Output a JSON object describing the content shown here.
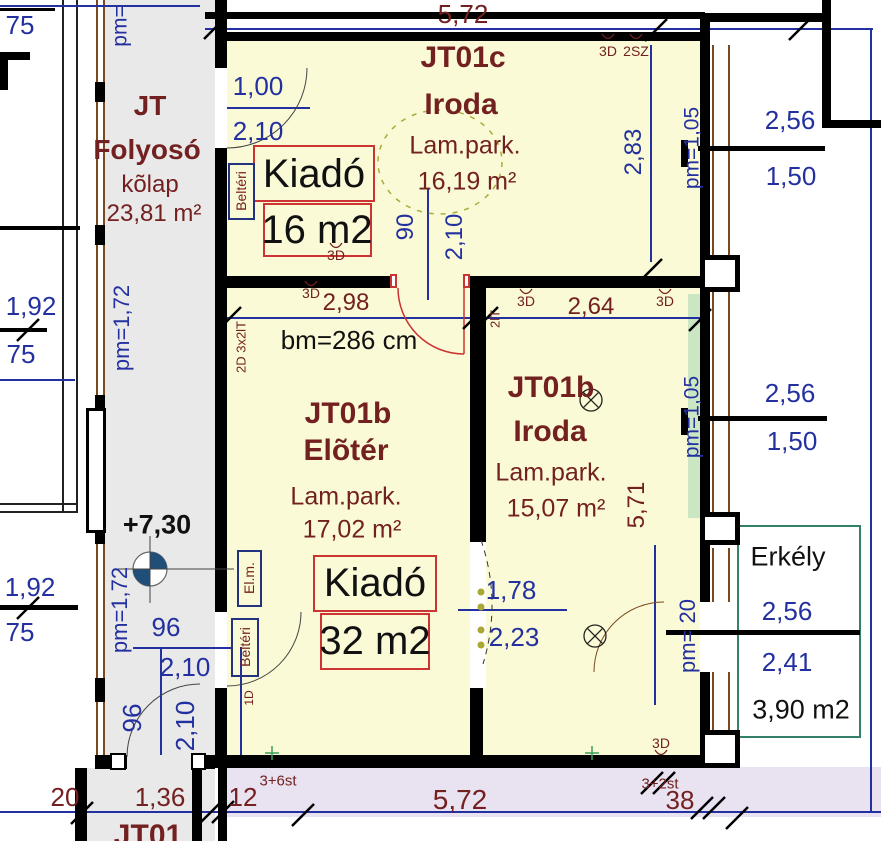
{
  "corridor": {
    "title1": "JT",
    "title2": "Folyosó",
    "floor": "kõlap",
    "area": "23,81 m²",
    "level": "+7,30",
    "unit_below": "JT01"
  },
  "office_c": {
    "unit": "JT01c",
    "type": "Iroda",
    "floor": "Lam.park.",
    "area": "16,19 m²"
  },
  "hall_b": {
    "unit": "JT01b",
    "type": "Elõtér",
    "floor": "Lam.park.",
    "area": "17,02 m²"
  },
  "office_b": {
    "unit": "JT01b",
    "type": "Iroda",
    "floor": "Lam.park.",
    "area": "15,07 m²"
  },
  "balcony": {
    "title": "Erkély",
    "width": "2,56",
    "depth": "2,41",
    "area": "3,90 m2"
  },
  "rent_small": {
    "label": "Kiadó",
    "area": "16 m2"
  },
  "rent_large": {
    "label": "Kiadó",
    "area": "32 m2"
  },
  "clearance": "bm=286 cm",
  "dims_red": {
    "top_width": "5,72",
    "w298": "2,98",
    "w264": "2,64",
    "h571": "5,71",
    "b20": "20",
    "b136": "1,36",
    "b12": "12",
    "b572": "5,72",
    "b38": "38",
    "st_up": "3+6st",
    "st_down": "3+2st"
  },
  "dims_blue": {
    "d75": "75",
    "d100": "1,00",
    "d210": "2,10",
    "d90": "90",
    "d283": "2,83",
    "d256": "2,56",
    "d150": "1,50",
    "d192": "1,92",
    "d96": "96",
    "d178": "1,78",
    "d223": "2,23",
    "pm_top": "pm=",
    "pm105": "pm=1,05",
    "pm172": "pm=1,72",
    "pm20": "pm= 20"
  },
  "tags": {
    "d3": "3D",
    "sz2": "2SZ",
    "win2d": "2D 3x2lT",
    "lt2": "2lT",
    "d1": "1D",
    "interior_door": "Beltéri",
    "meter": "El.m."
  },
  "colors": {
    "room_fill": "#FAFAD6",
    "corridor_fill": "#E9E9E9",
    "strip_fill": "#E9E3F1",
    "dim_blue": "#23309F",
    "label_red": "#732020",
    "box_red": "#CC3333",
    "balcony_green": "#35806B",
    "highlight_green": "#CBE6C3"
  }
}
